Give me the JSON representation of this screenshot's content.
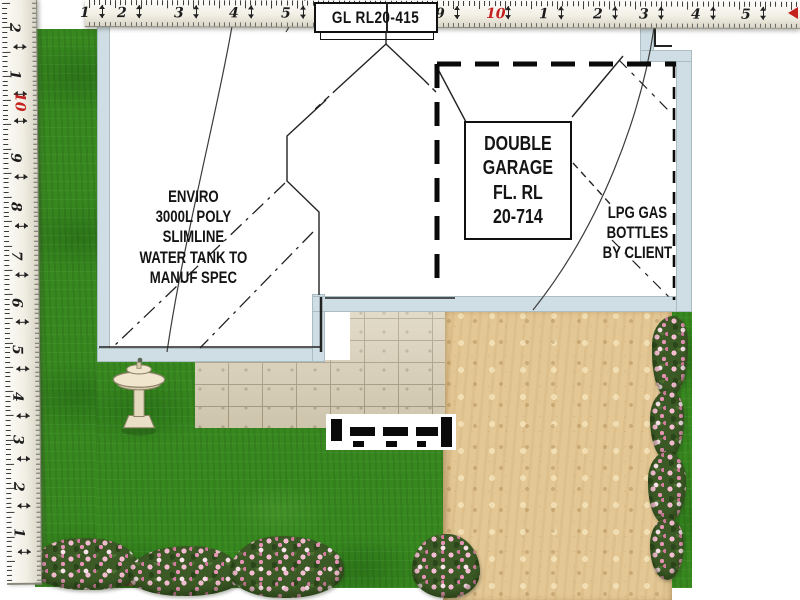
{
  "plan": {
    "labels": {
      "gl_box": "GL RL20-415",
      "garage_box": "DOUBLE\nGARAGE\nFL. RL\n20-714",
      "water_tank": "ENVIRO\n3000L POLY\nSLIMLINE\nWATER TANK TO\nMANUF SPEC",
      "lpg": "LPG GAS\nBOTTLES\nBY CLIENT"
    },
    "features": [
      "double-garage-dashed-outline",
      "garage-door-symbol",
      "paved-area",
      "sand-path",
      "lawn",
      "flower-borders",
      "bird-bath",
      "water-tank-note",
      "lpg-note"
    ]
  },
  "rulers": {
    "top": {
      "numbers": [
        {
          "t": "1",
          "x": 3
        },
        {
          "t": "2",
          "x": 40
        },
        {
          "t": "3",
          "x": 97
        },
        {
          "t": "4",
          "x": 152
        },
        {
          "t": "5",
          "x": 204
        },
        {
          "t": "9",
          "x": 358
        },
        {
          "t": "10",
          "x": 409,
          "red": true
        },
        {
          "t": "1",
          "x": 462
        },
        {
          "t": "2",
          "x": 516
        },
        {
          "t": "3",
          "x": 562
        },
        {
          "t": "4",
          "x": 614
        },
        {
          "t": "5",
          "x": 664
        }
      ]
    },
    "left": {
      "numbers": [
        {
          "t": "2",
          "y": 28
        },
        {
          "t": "1",
          "y": 75
        },
        {
          "t": "10",
          "y": 102,
          "red": true
        },
        {
          "t": "9",
          "y": 158
        },
        {
          "t": "8",
          "y": 207
        },
        {
          "t": "7",
          "y": 256
        },
        {
          "t": "6",
          "y": 303
        },
        {
          "t": "5",
          "y": 350
        },
        {
          "t": "4",
          "y": 397
        },
        {
          "t": "3",
          "y": 440
        },
        {
          "t": "2",
          "y": 487
        },
        {
          "t": "1",
          "y": 533
        }
      ]
    }
  },
  "colors": {
    "grass": "#37881f",
    "sand": "#e3c795",
    "wall": "#cfdee4",
    "tile": "#d9cfb6",
    "flower_pink": "#f5bdd2",
    "foliage": "#3c5a26",
    "ruler_red": "#c4201d",
    "ink": "#141414"
  }
}
